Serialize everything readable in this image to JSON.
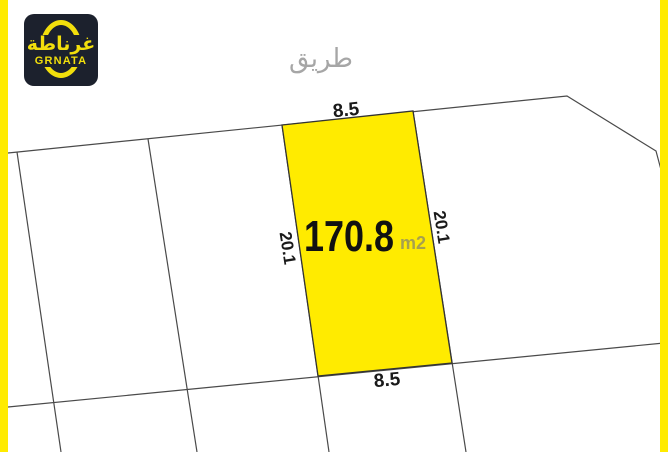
{
  "branding": {
    "logo_arabic": "غرناطة",
    "logo_latin": "GRNATA"
  },
  "map": {
    "road_label": "طريق",
    "highlighted_plot": {
      "area_value": "170.8",
      "area_unit": "m2",
      "top_length": "8.5",
      "bottom_length": "8.5",
      "left_length": "20.1",
      "right_length": "20.1"
    }
  },
  "colors": {
    "accent_yellow": "#FFEB00",
    "plot_fill": "#FFEB00",
    "boundary_line": "#4a4a4a",
    "area_text": "#111111",
    "muted_text": "#a6a6a6",
    "logo_background": "#1c212d",
    "logo_accent": "#f2df0c"
  }
}
